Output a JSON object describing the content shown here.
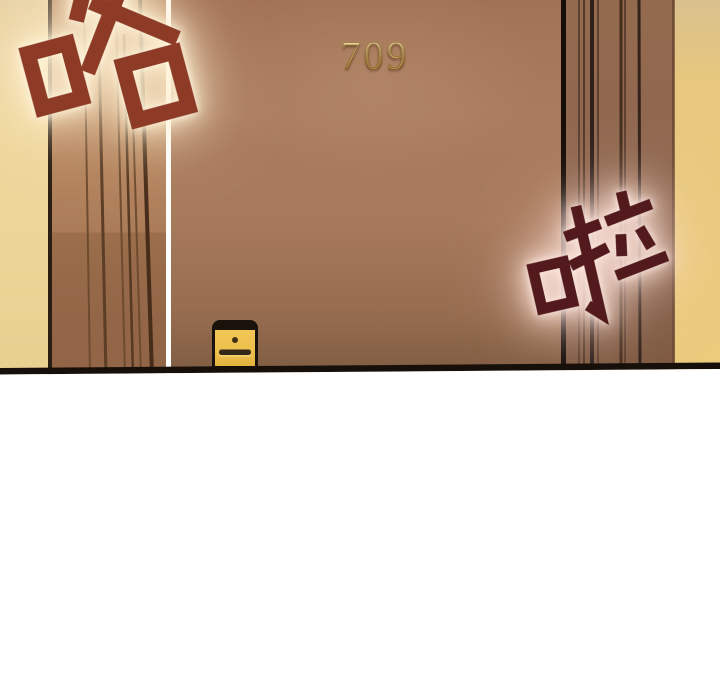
{
  "panel": {
    "door": {
      "number": "709"
    },
    "sfx": {
      "top_left": {
        "text": "咯"
      },
      "right": {
        "text": "啦"
      }
    },
    "colors": {
      "wall_tan_left": "#edd59a",
      "wall_tan_right": "#eaca7e",
      "door_brown": "#a87a5c",
      "doorframe_brown_left": "#b2835c",
      "doorframe_brown_right": "#8f6750",
      "door_number_gold": "#eccb7e",
      "sfx_top_left_red": "#8d3b26",
      "sfx_right_maroon": "#521a1c",
      "sfx_glow_warm": "#fff3da",
      "sfx_glow_pink": "#ffe8e0",
      "lock_plate_gold": "#eec14e",
      "floor_line_dark": "#17100a",
      "gutter_white": "#ffffff"
    }
  }
}
